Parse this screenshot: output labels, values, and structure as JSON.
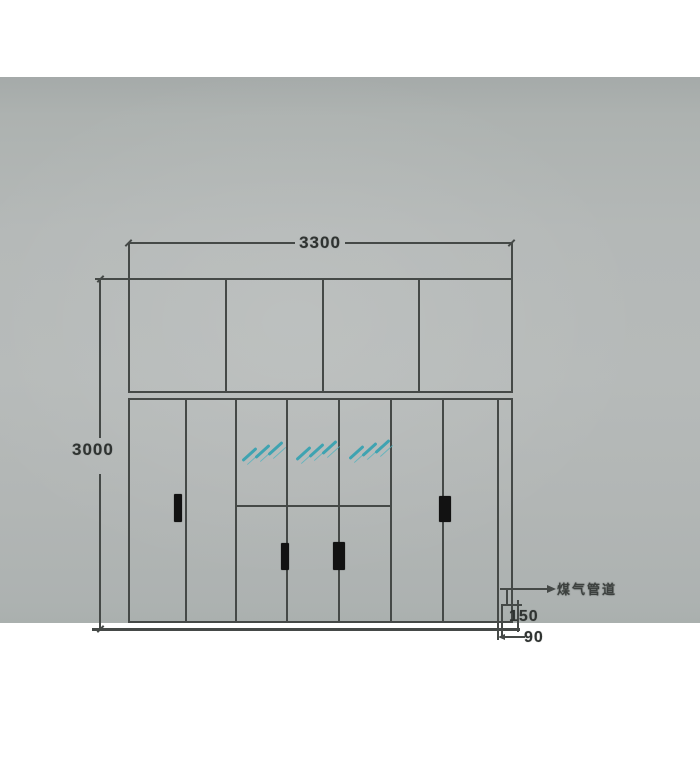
{
  "drawing": {
    "dim_width_top": "3300",
    "dim_height_left": "3000",
    "dim_pipe_chase": "150",
    "dim_pipe_offset": "90",
    "gas_pipe_label": "煤气管道",
    "colors": {
      "paper": "#b4b8b7",
      "ink": "#454947",
      "mirror_hatch": "#3fa3b1",
      "handle": "#121212"
    }
  }
}
